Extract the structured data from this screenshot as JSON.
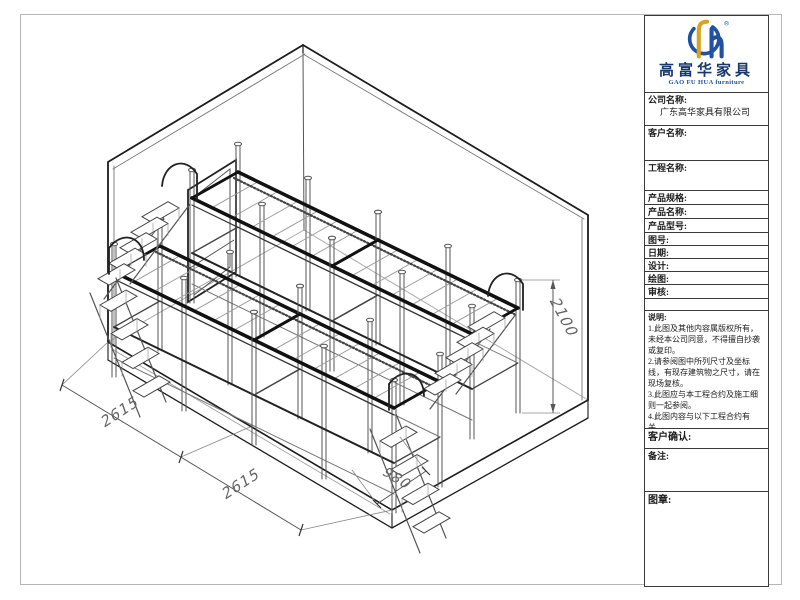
{
  "sheet": {
    "bg": "#ffffff",
    "frame_color": "#b6b6b6",
    "line_color": "#1c1c1c"
  },
  "logo": {
    "brand_cn": "高富华家具",
    "brand_en": "GAO FU HUA furniture",
    "registered": "®",
    "gold": "#d6a41e",
    "blue": "#2050a0",
    "navy": "#17386e"
  },
  "title_block": {
    "company_label": "公司名称:",
    "company_value": "广东高华家具有限公司",
    "customer_label": "客户名称:",
    "project_label": "工程名称:",
    "spec_label": "产品规格:",
    "product_name_label": "产品名称:",
    "model_label": "产品型号:",
    "drawing_no_label": "图号:",
    "date_label": "日期:",
    "design_label": "设计:",
    "draft_label": "绘图:",
    "audit_label": "审核:",
    "notes_label": "说明:",
    "notes": [
      "1.此图及其他内容属版权所有，未经本公司同意，不得擅自抄袭或复印。",
      "2.请参阅图中所列尺寸及坐标线，有现存建筑物之尺寸，请在现场复核。",
      "3.此图应与本工程合约及施工细则一起参阅。",
      "4.此图内容与以下工程合约有关。"
    ],
    "confirm_label": "客户确认:",
    "remark_label": "备注:",
    "stamp_label": "图章:"
  },
  "drawing": {
    "dimensions": {
      "left_depth_a": "2615",
      "left_depth_b": "2615",
      "stair_width": "980",
      "bed_height": "2100"
    }
  }
}
